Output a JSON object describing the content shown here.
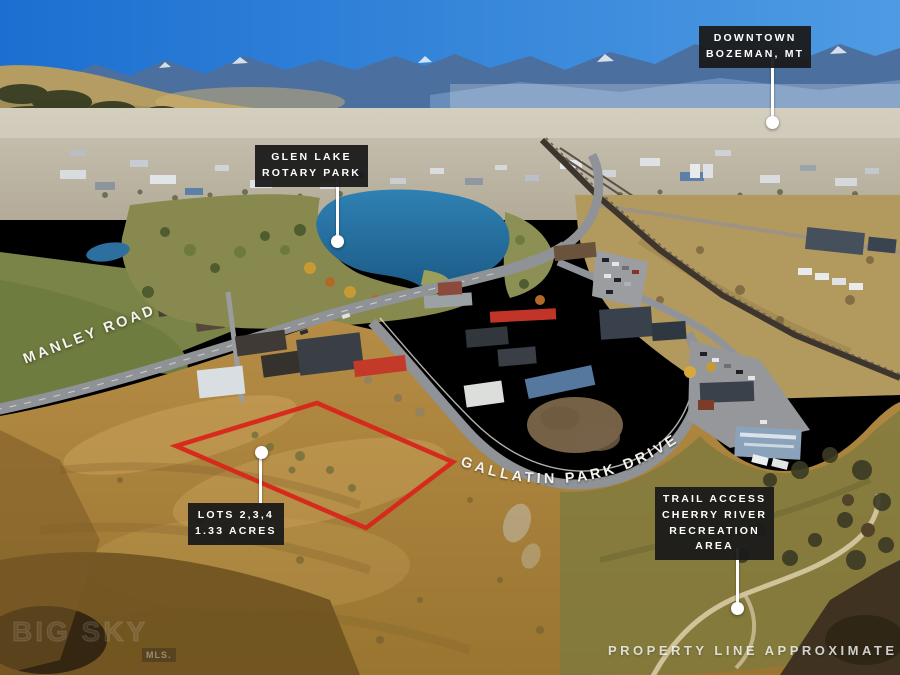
{
  "annotations": {
    "downtown": {
      "lines": [
        "DOWNTOWN",
        "BOZEMAN, MT"
      ]
    },
    "glen_lake": {
      "lines": [
        "GLEN LAKE",
        "ROTARY PARK"
      ]
    },
    "lots": {
      "lines": [
        "LOTS 2,3,4",
        "1.33 ACRES"
      ]
    },
    "trail_access": {
      "lines": [
        "TRAIL ACCESS",
        "CHERRY RIVER",
        "RECREATION",
        "AREA"
      ]
    },
    "manley_road": "MANLEY ROAD",
    "gallatin_park_drive": "GALLATIN PARK DRIVE",
    "property_line_note": "PROPERTY LINE APPROXIMATE"
  },
  "watermark": {
    "text": "BIG SKY",
    "badge": "MLS."
  },
  "colors": {
    "property_outline": "#d8251b",
    "label_background": "#1a1a1a",
    "label_text": "#ffffff",
    "callout_line": "#ffffff",
    "lake": "#2a74a8",
    "sky": "#2b7bd6"
  }
}
